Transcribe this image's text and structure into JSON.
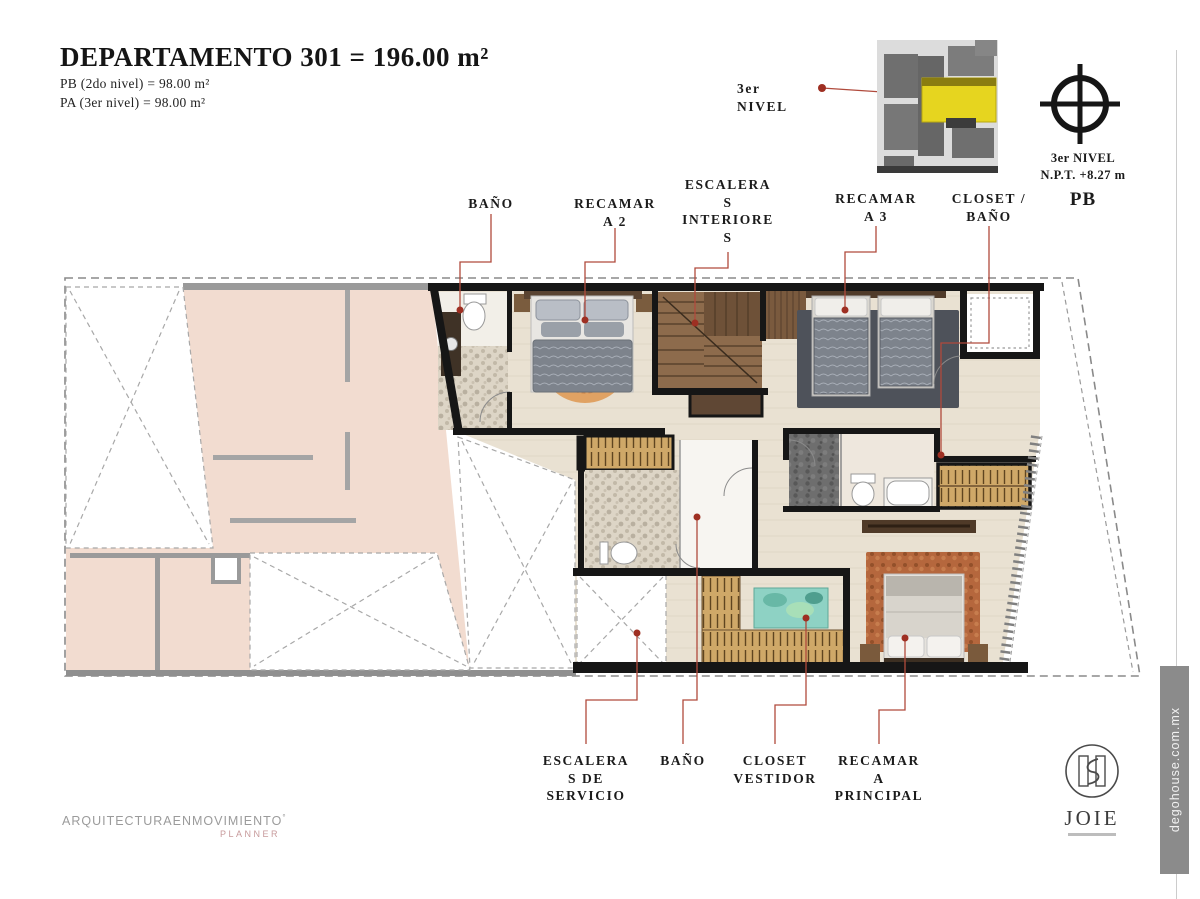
{
  "header": {
    "title": "DEPARTAMENTO 301 = 196.00 m²",
    "area_pb": "PB  (2do nivel) = 98.00 m²",
    "area_pa": "PA  (3er nivel) = 98.00 m²"
  },
  "level_callout": {
    "text": "3er\nNIVEL"
  },
  "compass": {
    "lines": "3er NIVEL\nN.P.T. +8.27 m",
    "level": "PB"
  },
  "plan_labels": {
    "top": [
      {
        "id": "bano-2",
        "text": "BAÑO"
      },
      {
        "id": "recamara-2",
        "text": "RECAMAR\nA 2"
      },
      {
        "id": "escaleras-interiores",
        "text": "ESCALERA\nS\nINTERIORE\nS"
      },
      {
        "id": "recamara-3",
        "text": "RECAMAR\nA 3"
      },
      {
        "id": "closet-bano",
        "text": "CLOSET /\nBAÑO"
      }
    ],
    "bottom": [
      {
        "id": "escaleras-servicio",
        "text": "ESCALERA\nS DE\nSERVICIO"
      },
      {
        "id": "bano-principal",
        "text": "BAÑO"
      },
      {
        "id": "closet-vestidor",
        "text": "CLOSET\nVESTIDOR"
      },
      {
        "id": "recamara-principal",
        "text": "RECAMAR\nA\nPRINCIPAL"
      }
    ]
  },
  "footer_brand": {
    "name": "ARQUITECTURAENMOVIMIENTO",
    "mark": "°",
    "sub": "PLANNER"
  },
  "joie": {
    "name": "JOIE"
  },
  "watermark": {
    "text": "degohouse.com.mx"
  },
  "colors": {
    "accent_red": "#b04a3c",
    "dot_red": "#9e2f22",
    "unit_floor": "#e9e1d2",
    "adjacent_pink": "#f2dcd0",
    "wall_black": "#161616",
    "wall_gray": "#9a9a9a",
    "stairs_wood": "#8d6b4c",
    "closet_wood": "#cfa868",
    "rug_orange": "#e0a263",
    "rug_rust": "#b5673d",
    "rug_gray": "#4e525a",
    "island_teal": "#8ed2c4",
    "highlight_yellow": "#e6d51f",
    "block_gray": "#6f6f6f"
  }
}
